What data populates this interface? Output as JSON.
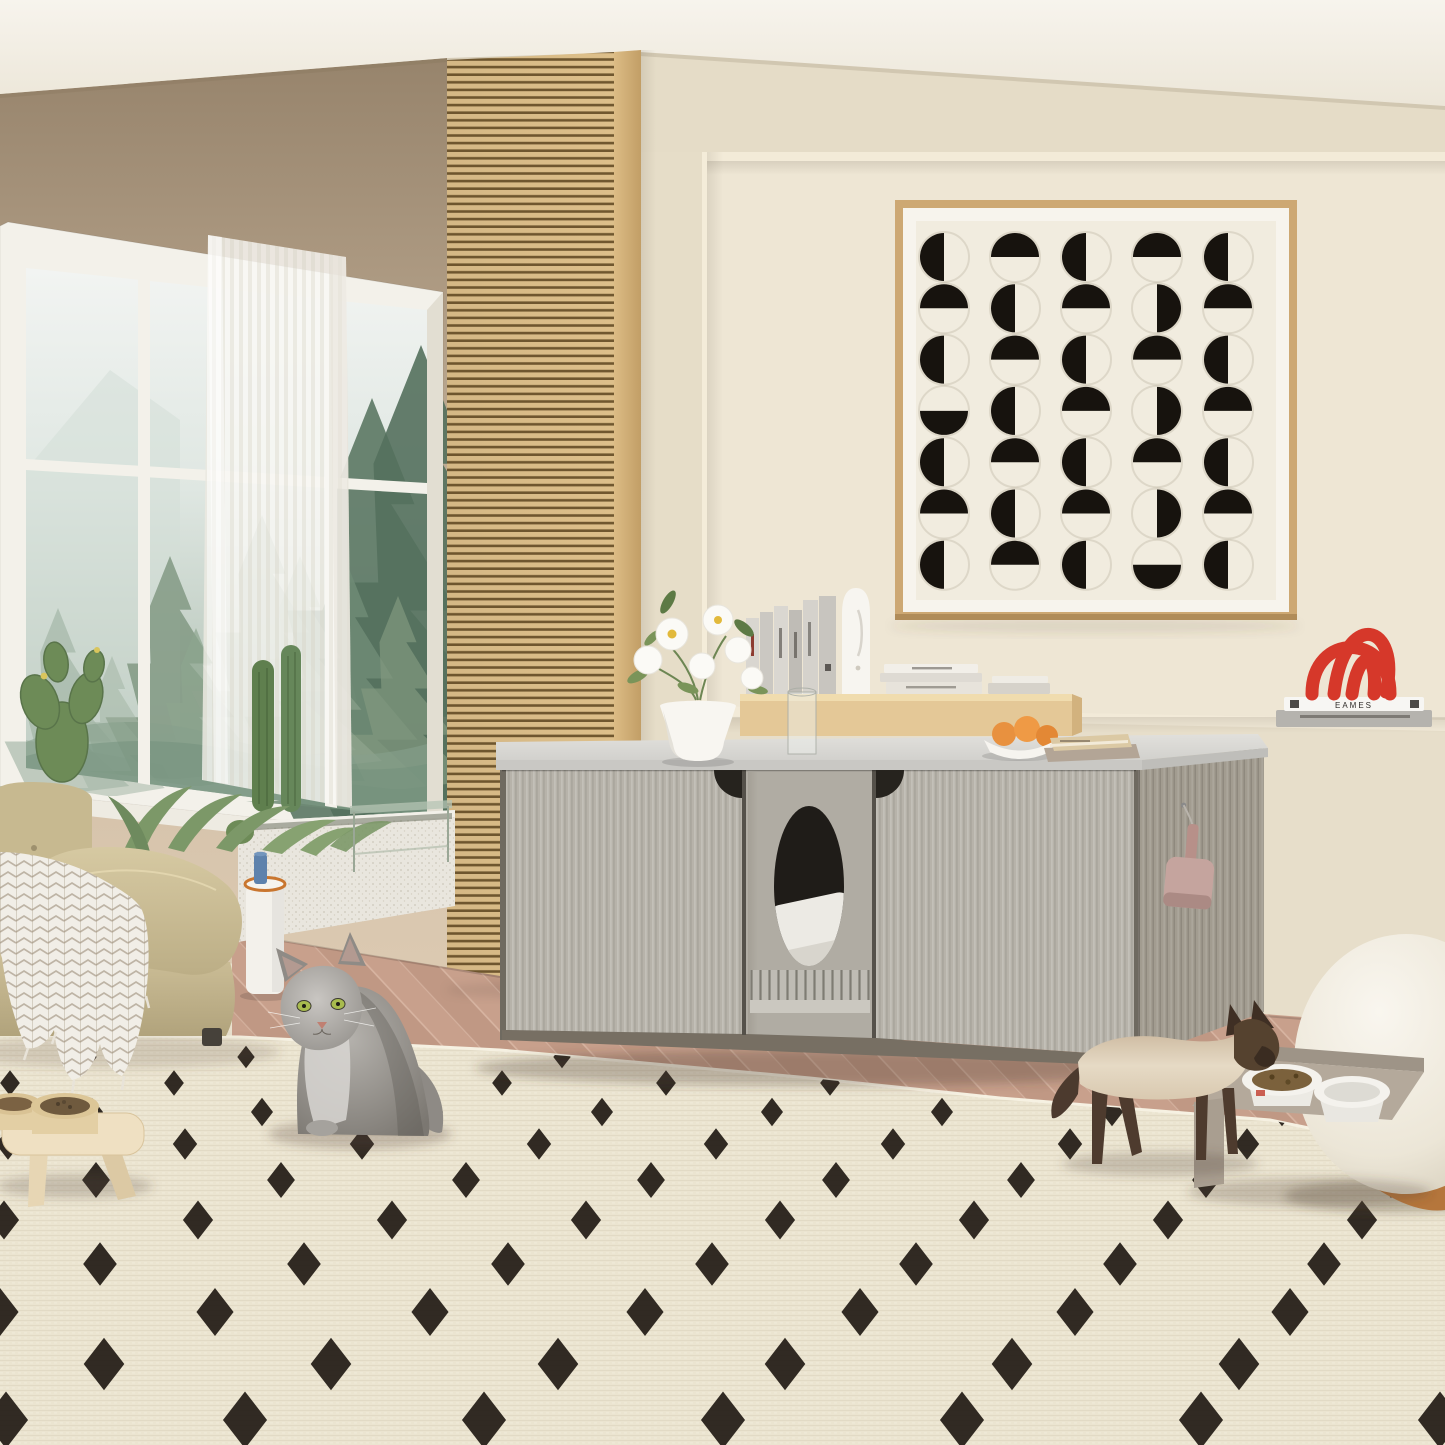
{
  "page": {
    "title": "Cream living room with cat litter box enclosure cabinet and two cats"
  },
  "scene": {
    "setting": "modern cream living room with misty forest window view",
    "subject": "gray wood-grain cat litter box enclosure sideboard with oval entry and litter grate",
    "animals": [
      "gray long-haired cat sitting on rug",
      "siamese cat walking to food bowls"
    ]
  },
  "palette": {
    "ceiling": "#f5f2ea",
    "wall": "#eae2d0",
    "wall_upper_left": "#9b8870",
    "niche_wall": "#eee6d4",
    "slat_wood": "#dcbe8b",
    "slat_gap": "#70572f",
    "window_frame": "#f3f1ea",
    "cabinet_door": "#b7b3aa",
    "cabinet_side": "#a39d92",
    "counter": "#d9d8d4",
    "floor_wood": "#c7a18d",
    "rug_base": "#ebe4d0",
    "rug_diamond": "#211a14",
    "sofa": "#ccbe97",
    "throw": "#f1eee7",
    "accent_red": "#d6382a",
    "orange_fruit": "#e8913f",
    "scoop_pink": "#c5a49e",
    "pouf": "#f3efe6",
    "art_frame": "#cda873",
    "art_ink": "#17130e",
    "cat_gray": "#9a9792",
    "siamese_point": "#4e3b2c",
    "siamese_body": "#e3d6c0"
  },
  "art": {
    "description": "framed half-moon circle grid print, 5 columns x 7 rows",
    "circle_color": "#17130e",
    "grid": [
      "LTLTL",
      "TLTRT",
      "LTLTL",
      "BLTRT",
      "LTLTL",
      "TLTRT",
      "LTLBL"
    ]
  },
  "rug": {
    "base": "#ebe4d0",
    "diamond_color": "#211a14",
    "rows": [
      {
        "y": 1057,
        "s": 15,
        "p": 158,
        "x0": 88
      },
      {
        "y": 1083,
        "s": 17,
        "p": 164,
        "x0": 10
      },
      {
        "y": 1112,
        "s": 19,
        "p": 170,
        "x0": 92
      },
      {
        "y": 1144,
        "s": 21,
        "p": 177,
        "x0": 8
      },
      {
        "y": 1180,
        "s": 24,
        "p": 185,
        "x0": 96
      },
      {
        "y": 1220,
        "s": 26,
        "p": 194,
        "x0": 4
      },
      {
        "y": 1264,
        "s": 29,
        "p": 204,
        "x0": 100
      },
      {
        "y": 1312,
        "s": 32,
        "p": 215,
        "x0": 0
      },
      {
        "y": 1364,
        "s": 35,
        "p": 227,
        "x0": 104
      },
      {
        "y": 1420,
        "s": 38,
        "p": 239,
        "x0": 6
      }
    ]
  },
  "window": {
    "trees": [
      {
        "x": 372,
        "y": 398,
        "h": 425,
        "c": "#5e7a66",
        "o": 0.92
      },
      {
        "x": 421,
        "y": 345,
        "h": 475,
        "c": "#54705d",
        "o": 0.9
      },
      {
        "x": 344,
        "y": 556,
        "h": 245,
        "c": "#6f8b76",
        "o": 0.85
      },
      {
        "x": 398,
        "y": 596,
        "h": 185,
        "c": "#81997f",
        "o": 0.7
      },
      {
        "x": 170,
        "y": 556,
        "h": 215,
        "c": "#7d957e",
        "o": 0.8
      },
      {
        "x": 196,
        "y": 628,
        "h": 150,
        "c": "#8da58e",
        "o": 0.7
      },
      {
        "x": 262,
        "y": 515,
        "h": 235,
        "c": "#8fa48f",
        "o": 0.5
      },
      {
        "x": 300,
        "y": 556,
        "h": 205,
        "c": "#97ab96",
        "o": 0.5
      },
      {
        "x": 58,
        "y": 608,
        "h": 178,
        "c": "#9cb0a0",
        "o": 0.6
      },
      {
        "x": 112,
        "y": 656,
        "h": 132,
        "c": "#a4b6a6",
        "o": 0.55
      }
    ]
  },
  "ledge_books": {
    "top_label": "EAMES"
  },
  "objects": [
    "window with forest view",
    "sheer curtain",
    "wood slat column",
    "half-moon wall art",
    "litter box enclosure cabinet",
    "flower vase",
    "book riser",
    "face sculpture",
    "fruit bowl",
    "red arch sculpture",
    "EAMES books on ledge",
    "litter scoop",
    "beige sofa",
    "herringbone throw",
    "cactus planter",
    "side table",
    "dotted area rug",
    "raised pet bowls left",
    "raised pet bowls right",
    "gray long-haired cat",
    "siamese cat",
    "boucle pouf"
  ]
}
